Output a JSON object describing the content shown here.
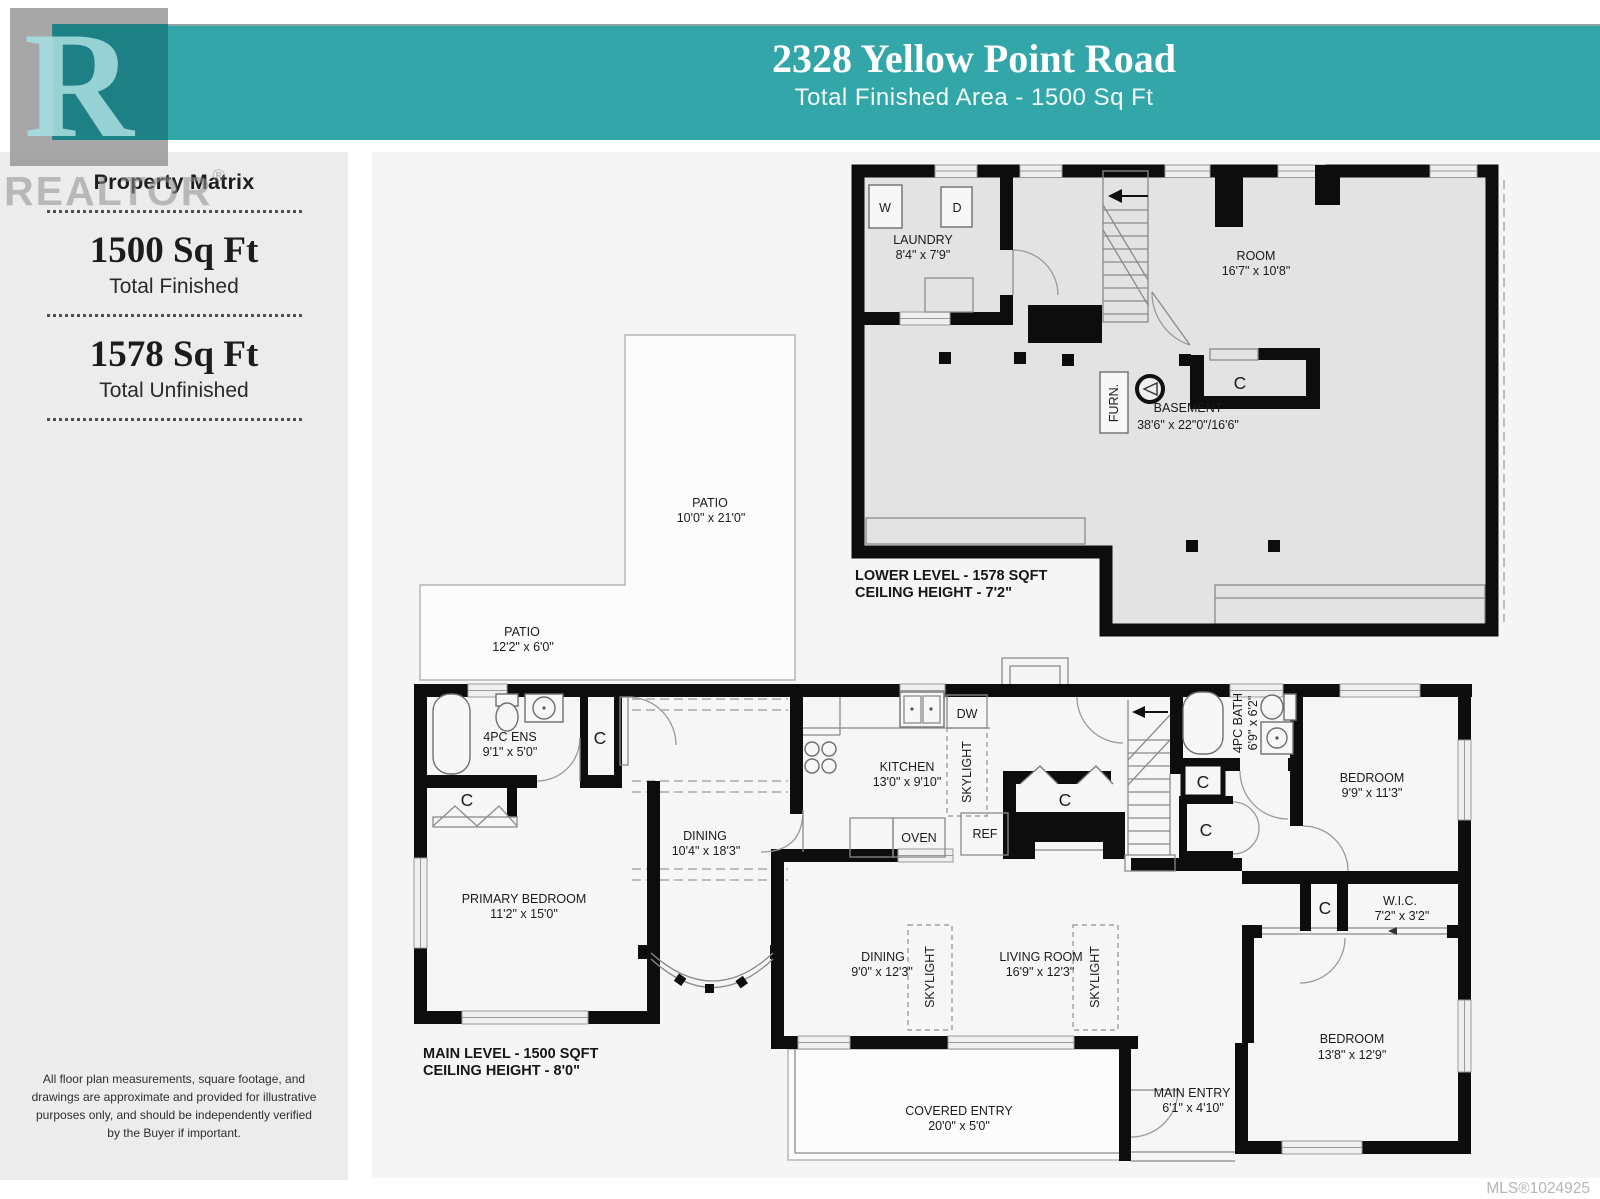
{
  "header": {
    "title": "2328 Yellow Point Road",
    "subtitle": "Total Finished Area - 1500 Sq Ft"
  },
  "watermark": {
    "logo_letter": "R",
    "realtor_text": "REALTOR",
    "reg_mark": "®"
  },
  "sidebar": {
    "brand": "Property Matrix",
    "stats": [
      {
        "value": "1500 Sq Ft",
        "label": "Total Finished"
      },
      {
        "value": "1578 Sq Ft",
        "label": "Total Unfinished"
      }
    ],
    "disclaimer": "All floor plan measurements, square footage, and drawings are approximate and provided for illustrative purposes only, and should be independently verified by the Buyer if important."
  },
  "footer": {
    "mls": "MLS®1024925"
  },
  "lower_level": {
    "title": "LOWER LEVEL - 1578 SQFT",
    "ceiling": "CEILING HEIGHT - 7'2\"",
    "laundry_name": "LAUNDRY",
    "laundry_dims": "8'4\" x 7'9\"",
    "washer": "W",
    "dryer": "D",
    "room_name": "ROOM",
    "room_dims": "16'7\" x 10'8\"",
    "basement_name": "BASEMENT",
    "basement_dims": "38'6\" x 22\"0\"/16'6\"",
    "furnace": "FURN.",
    "closet": "C"
  },
  "patios": {
    "patio1_name": "PATIO",
    "patio1_dims": "10'0\" x 21'0\"",
    "patio2_name": "PATIO",
    "patio2_dims": "12'2\" x 6'0\""
  },
  "main_level": {
    "title": "MAIN LEVEL - 1500 SQFT",
    "ceiling": "CEILING HEIGHT - 8'0\"",
    "ensuite_name": "4PC ENS",
    "ensuite_dims": "9'1\" x 5'0\"",
    "primary_name": "PRIMARY BEDROOM",
    "primary_dims": "11'2\" x 15'0\"",
    "dining_name": "DINING",
    "dining_dims": "10'4\" x 18'3\"",
    "kitchen_name": "KITCHEN",
    "kitchen_dims": "13'0\" x 9'10\"",
    "dw": "DW",
    "oven": "OVEN",
    "ref": "REF",
    "skylight": "SKYLIGHT",
    "bath_name": "4PC BATH",
    "bath_dims": "6'9\" x 6'2\"",
    "bedroom1_name": "BEDROOM",
    "bedroom1_dims": "9'9\" x 11'3\"",
    "wic_name": "W.I.C.",
    "wic_dims": "7'2\" x 3'2\"",
    "bedroom2_name": "BEDROOM",
    "bedroom2_dims": "13'8\" x 12'9\"",
    "dining2_name": "DINING",
    "dining2_dims": "9'0\" x 12'3\"",
    "living_name": "LIVING ROOM",
    "living_dims": "16'9\" x 12'3\"",
    "covered_name": "COVERED ENTRY",
    "covered_dims": "20'0\" x 5'0\"",
    "entry_name": "MAIN ENTRY",
    "entry_dims": "6'1\" x 4'10\"",
    "closet": "C"
  },
  "colors": {
    "teal": "#33a6a9",
    "teal_dark": "#1b7d81",
    "wall": "#0d0d0d",
    "sidebar_bg": "#ececec"
  }
}
